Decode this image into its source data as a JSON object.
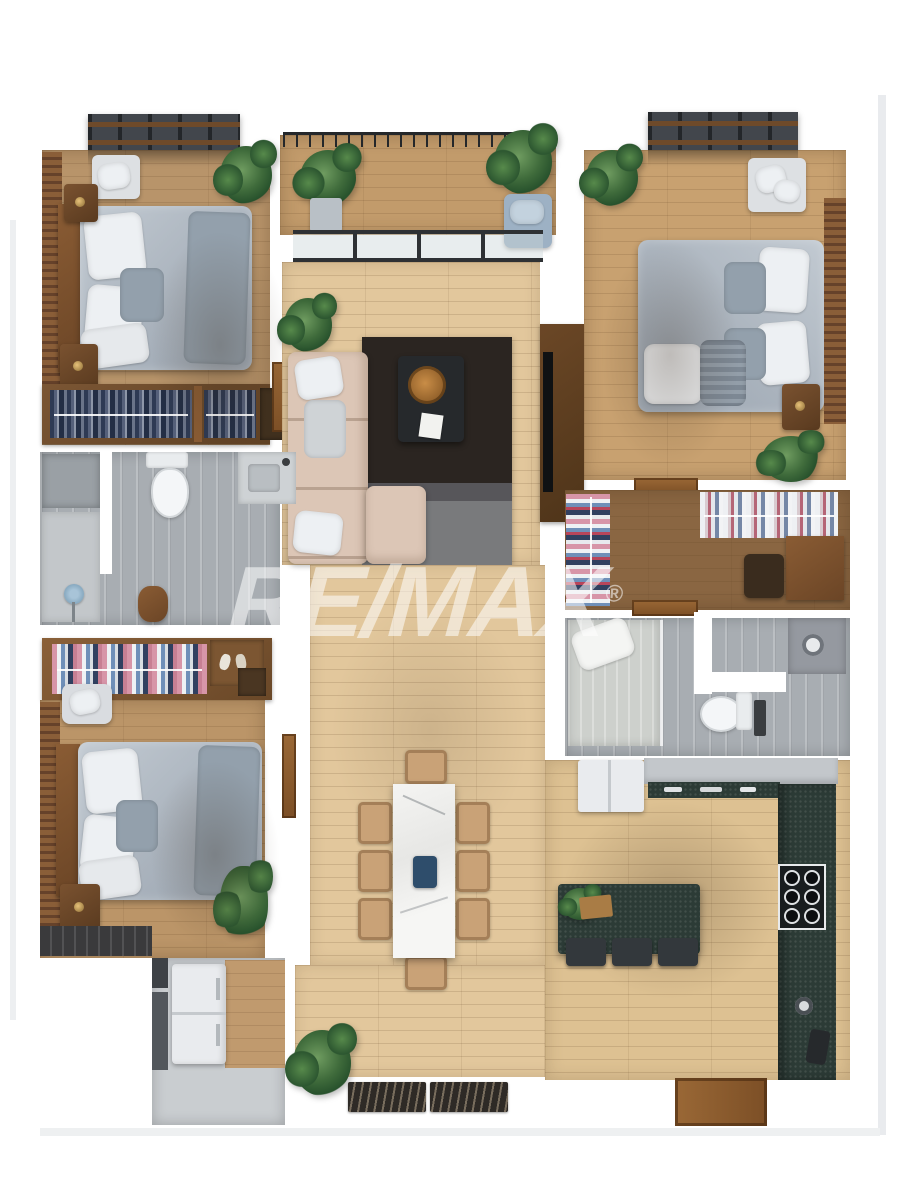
{
  "watermark": {
    "brand": "RE/MAX",
    "registered_mark": "®",
    "color": "#ffffff",
    "opacity": 0.55
  },
  "palette": {
    "floor_light": "#e2c79c",
    "floor_mid": "#b8946a",
    "floor_warm": "#c8a170",
    "floor_deck": "#c29b6b",
    "floor_dark": "#8a6642",
    "tile_gray": "#a8adb2",
    "counter_teal": "#2c3b36",
    "sofa_beige": "#dcc6b6",
    "bed_duvet": "#aab3bd",
    "pillow_white": "#edf0f3",
    "wood_dark": "#5e3d22",
    "wood_brown": "#8a5a2e",
    "rug_dark": "#2b2521",
    "rug_gray": "#797a7c",
    "plant_green": "#3f6b3b",
    "accent_blue": "#9db1c4",
    "appliance_white": "#e9ebee",
    "stool_dark": "#33383c",
    "mat_dark": "#2e2a26",
    "marble_white": "#f2f2f0"
  }
}
